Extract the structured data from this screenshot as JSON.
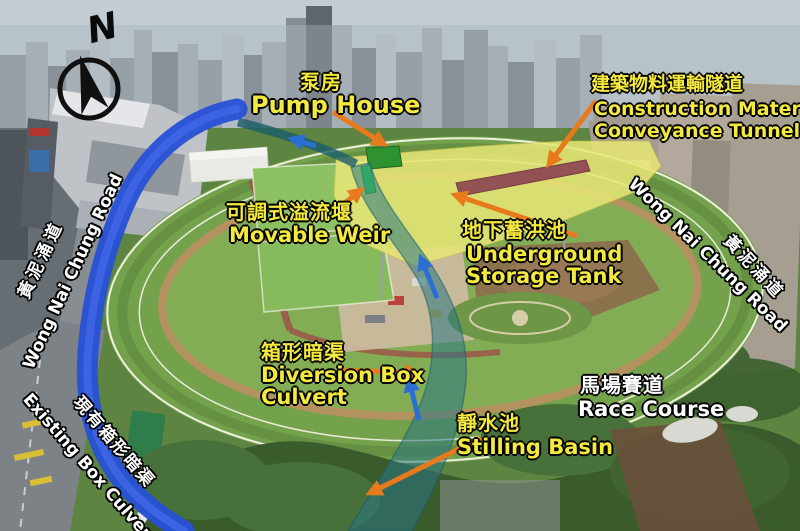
{
  "compass": {
    "n": "N"
  },
  "labels": {
    "pump_house": {
      "zh": "泵房",
      "en": "Pump House"
    },
    "conveyance_tunnel": {
      "zh": "建築物料運輸隧道",
      "en_line1": "Construction Material",
      "en_line2": "Conveyance Tunnel"
    },
    "movable_weir": {
      "zh": "可調式溢流堰",
      "en": "Movable Weir"
    },
    "storage_tank": {
      "zh": "地下蓄洪池",
      "en_line1": "Underground",
      "en_line2": "Storage Tank"
    },
    "diversion_culvert": {
      "zh": "箱形暗渠",
      "en_line1": "Diversion Box",
      "en_line2": "Culvert"
    },
    "race_course": {
      "zh": "馬場賽道",
      "en": "Race Course"
    },
    "stilling_basin": {
      "zh": "靜水池",
      "en": "Stilling Basin"
    },
    "road_left": {
      "zh": "黃泥涌道",
      "en": "Wong Nai Chung Road"
    },
    "road_right": {
      "zh": "黃泥涌道",
      "en": "Wong Nai Chung Road"
    },
    "existing_culvert": {
      "zh": "現有箱形暗渠",
      "en": "Existing Box Culvert"
    }
  },
  "colors": {
    "label_yellow": "#f4e93d",
    "label_white": "#ffffff",
    "arrow_orange": "#e87a1e",
    "arrow_blue": "#2b6fd4",
    "existing_culvert_blue": "#2750d6",
    "diversion_culvert_teal": "#2a7684",
    "storage_tank_yellow": "#e9e777",
    "pump_house_green": "#2f9231",
    "movable_weir_green": "#3fe24b",
    "conveyance_tunnel_maroon": "#8c4350"
  }
}
